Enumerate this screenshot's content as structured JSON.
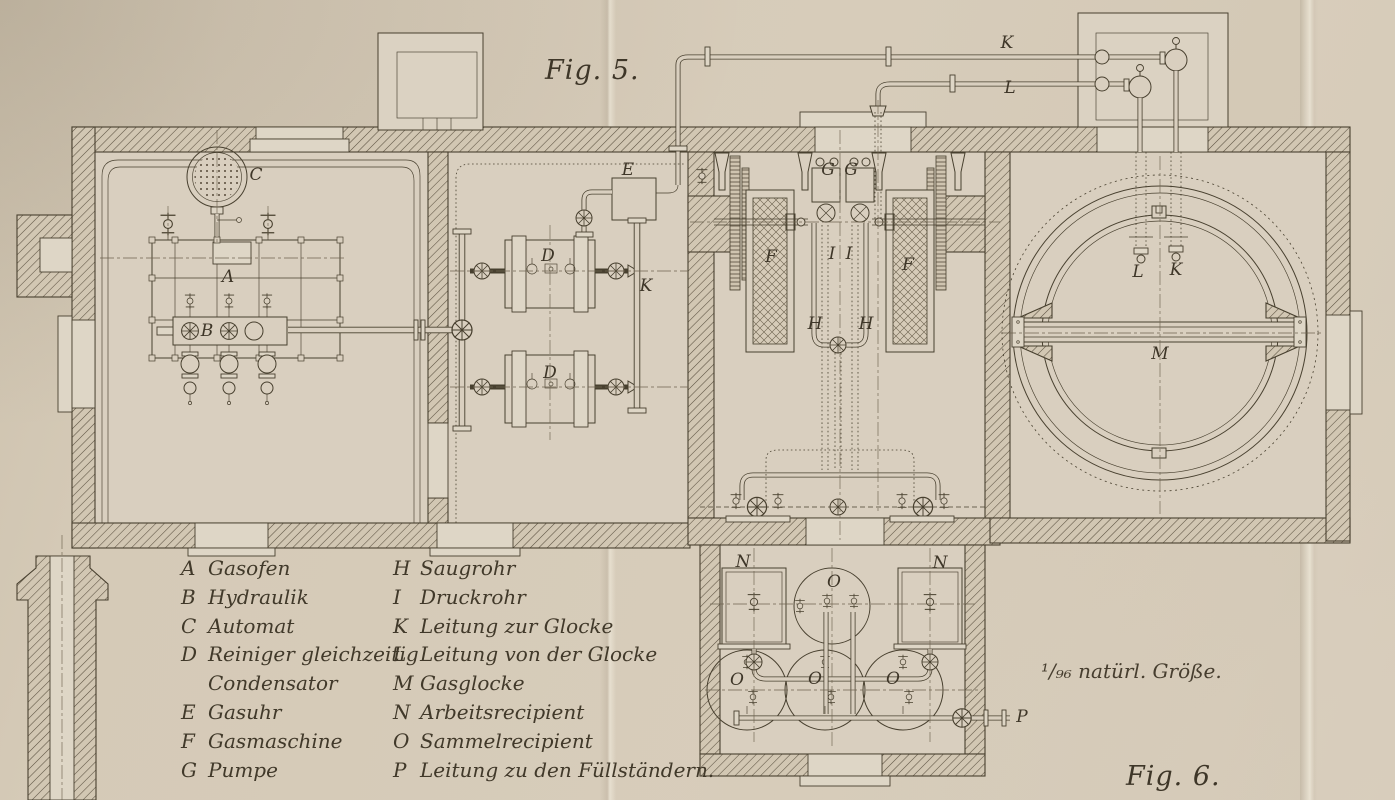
{
  "figure_labels": {
    "fig5": "Fig. 5.",
    "fig6": "Fig. 6.",
    "scale_note": "¹/₉₆ natürl. Größe."
  },
  "legend": {
    "left": [
      {
        "key": "A",
        "label": "Gasofen"
      },
      {
        "key": "B",
        "label": "Hydraulik"
      },
      {
        "key": "C",
        "label": "Automat"
      },
      {
        "key": "D",
        "label": "Reiniger gleichzeitig"
      },
      {
        "key": "",
        "label": "Condensator"
      },
      {
        "key": "E",
        "label": "Gasuhr"
      },
      {
        "key": "F",
        "label": "Gasmaschine"
      },
      {
        "key": "G",
        "label": "Pumpe"
      }
    ],
    "right": [
      {
        "key": "H",
        "label": "Saugrohr"
      },
      {
        "key": "I",
        "label": "Druckrohr"
      },
      {
        "key": "K",
        "label": "Leitung zur Glocke"
      },
      {
        "key": "L",
        "label": "Leitung von der Glocke"
      },
      {
        "key": "M",
        "label": "Gasglocke"
      },
      {
        "key": "N",
        "label": "Arbeitsrecipient"
      },
      {
        "key": "O",
        "label": "Sammelrecipient"
      },
      {
        "key": "P",
        "label": "Leitung zu den Füllständern."
      }
    ]
  },
  "annotations": [
    {
      "text": "C",
      "x": 256,
      "y": 175
    },
    {
      "text": "A",
      "x": 228,
      "y": 277
    },
    {
      "text": "B",
      "x": 207,
      "y": 331
    },
    {
      "text": "D",
      "x": 548,
      "y": 256
    },
    {
      "text": "D",
      "x": 550,
      "y": 373
    },
    {
      "text": "E",
      "x": 628,
      "y": 170
    },
    {
      "text": "K",
      "x": 646,
      "y": 286
    },
    {
      "text": "K",
      "x": 1007,
      "y": 43
    },
    {
      "text": "L",
      "x": 1010,
      "y": 88
    },
    {
      "text": "F",
      "x": 771,
      "y": 257
    },
    {
      "text": "F",
      "x": 908,
      "y": 265
    },
    {
      "text": "G",
      "x": 828,
      "y": 170
    },
    {
      "text": "G",
      "x": 851,
      "y": 170
    },
    {
      "text": "I",
      "x": 832,
      "y": 254
    },
    {
      "text": "I",
      "x": 849,
      "y": 254
    },
    {
      "text": "H",
      "x": 815,
      "y": 324
    },
    {
      "text": "H",
      "x": 866,
      "y": 324
    },
    {
      "text": "L",
      "x": 1138,
      "y": 272
    },
    {
      "text": "K",
      "x": 1176,
      "y": 270
    },
    {
      "text": "M",
      "x": 1160,
      "y": 354
    },
    {
      "text": "N",
      "x": 743,
      "y": 562
    },
    {
      "text": "N",
      "x": 940,
      "y": 563
    },
    {
      "text": "O",
      "x": 834,
      "y": 582
    },
    {
      "text": "O",
      "x": 737,
      "y": 680
    },
    {
      "text": "O",
      "x": 815,
      "y": 679
    },
    {
      "text": "O",
      "x": 893,
      "y": 679
    },
    {
      "text": "P",
      "x": 1022,
      "y": 717
    }
  ]
}
